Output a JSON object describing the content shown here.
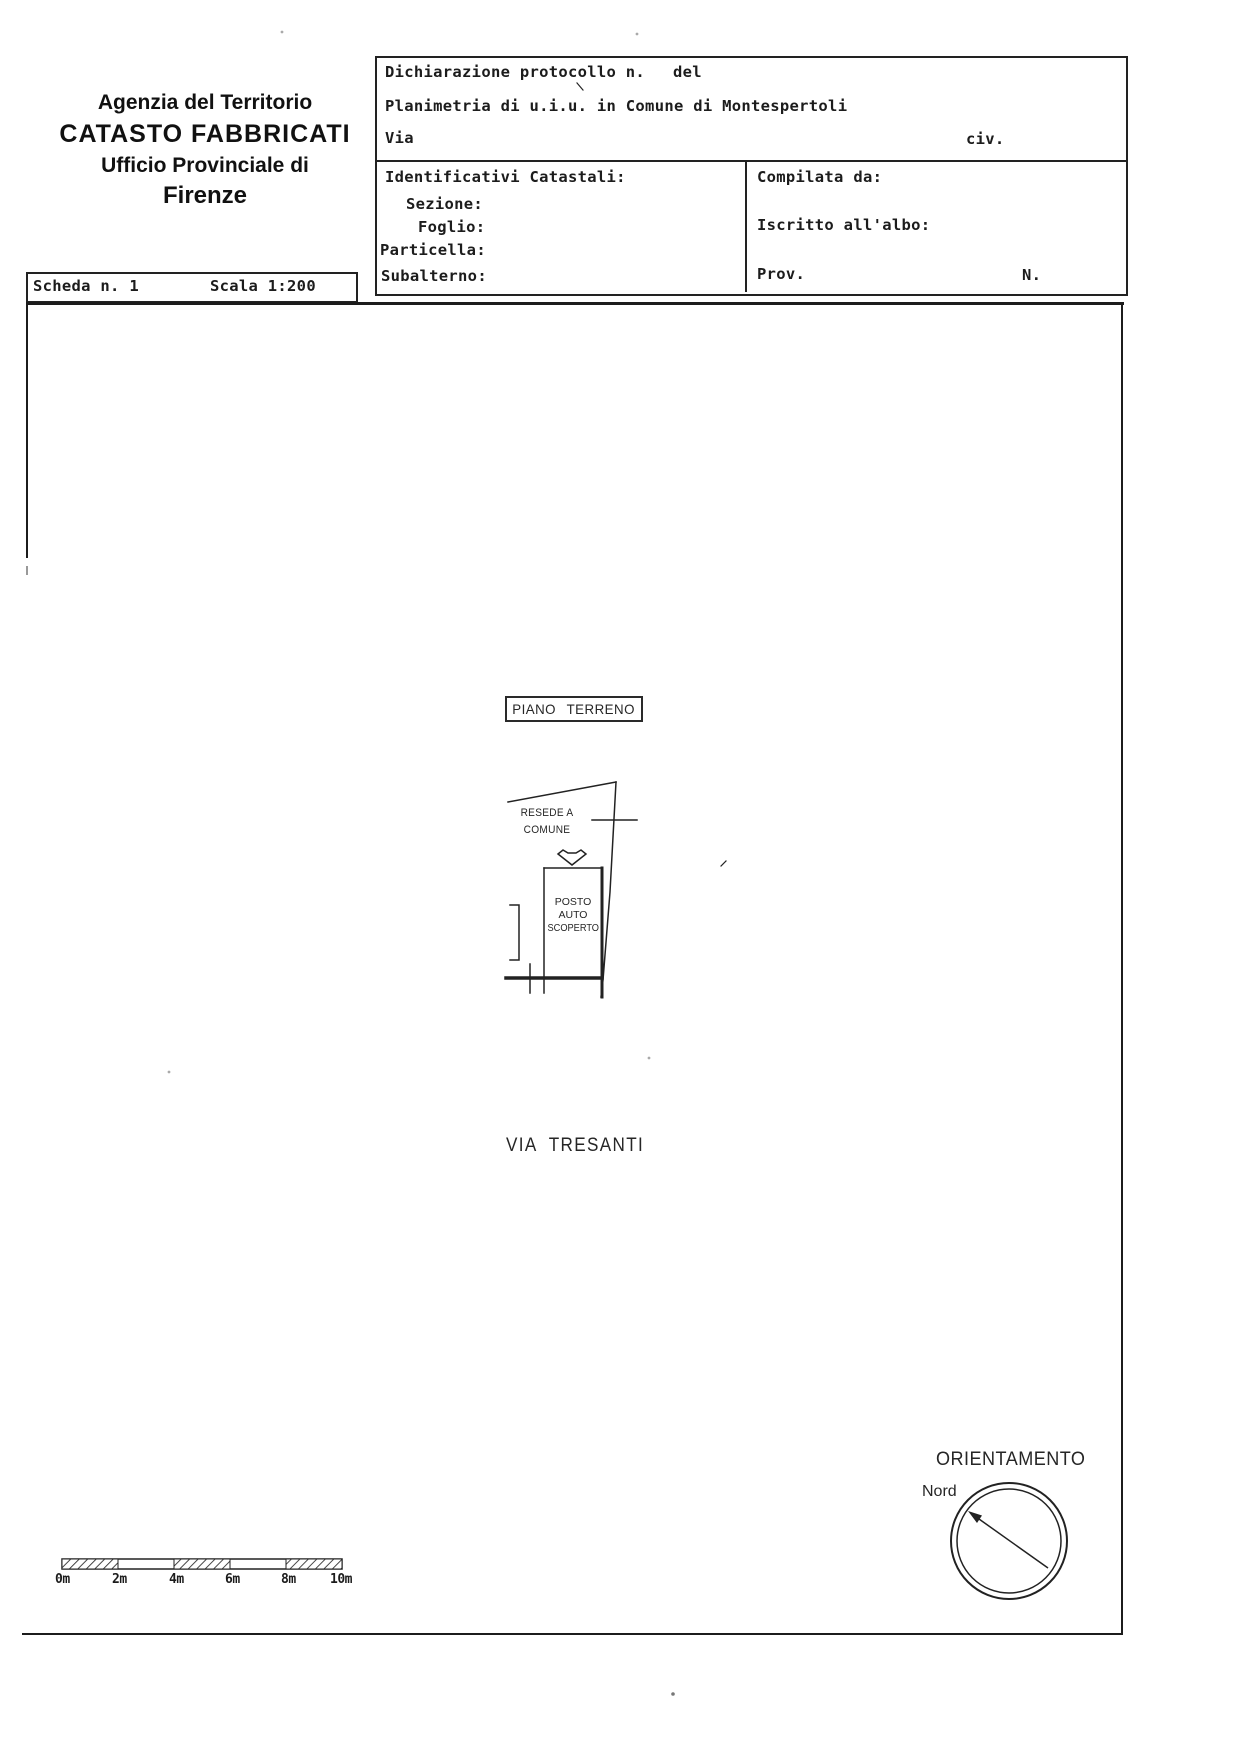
{
  "agency": {
    "line1": "Agenzia del Territorio",
    "line2": "CATASTO FABBRICATI",
    "line3": "Ufficio Provinciale di",
    "line4": "Firenze"
  },
  "declaration": {
    "protocol_label": "Dichiarazione protocollo n.",
    "del_label": "del",
    "planimetria_line": "Planimetria di u.i.u. in Comune di Montespertoli",
    "via_label": "Via",
    "civ_label": "civ."
  },
  "cadastral": {
    "title": "Identificativi Catastali:",
    "sezione": "Sezione:",
    "foglio": "Foglio:",
    "particella": "Particella:",
    "subalterno": "Subalterno:"
  },
  "compiler": {
    "title": "Compilata da:",
    "albo": "Iscritto all'albo:",
    "prov": "Prov.",
    "n": "N."
  },
  "scheda": {
    "number": "Scheda n. 1",
    "scale": "Scala 1:200"
  },
  "plan": {
    "floor_label": "PIANO TERRENO",
    "resede_line1": "RESEDE A",
    "resede_line2": "COMUNE",
    "posto_line1": "POSTO",
    "posto_line2": "AUTO",
    "posto_line3": "SCOPERTO",
    "street_name": "VIA TRESANTI"
  },
  "orientation": {
    "title": "ORIENTAMENTO",
    "north_label": "Nord"
  },
  "scalebar": {
    "labels": [
      "0m",
      "2m",
      "4m",
      "6m",
      "8m",
      "10m"
    ]
  },
  "colors": {
    "ink": "#1c1c1c",
    "paper": "#ffffff"
  }
}
